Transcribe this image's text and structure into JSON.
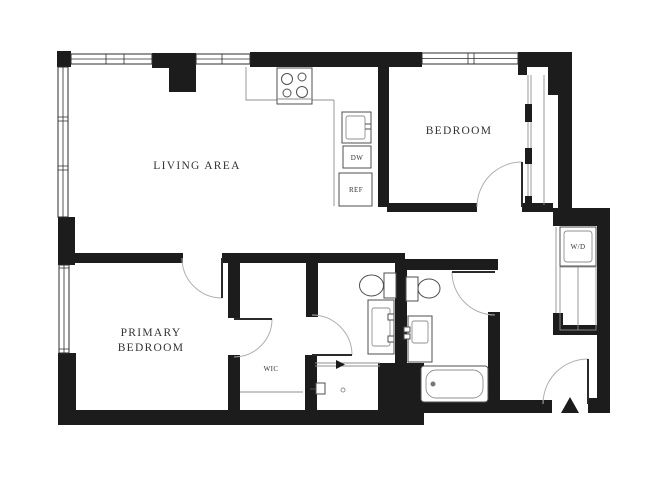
{
  "plan": {
    "type": "apartment-floor-plan",
    "colors": {
      "wall": "#1c1c1c",
      "label": "#333333",
      "fixture": "#4f4f4f",
      "background": "#ffffff"
    },
    "rooms": {
      "living_area": {
        "label": "LIVING AREA"
      },
      "bedroom": {
        "label": "BEDROOM"
      },
      "primary_bedroom": {
        "label_line_1": "PRIMARY",
        "label_line_2": "BEDROOM"
      },
      "wic": {
        "label": "WIC"
      }
    },
    "fixtures": {
      "dishwasher": {
        "label": "DW"
      },
      "refrigerator": {
        "label": "REF"
      },
      "washer_dryer": {
        "label": "W/D"
      }
    }
  }
}
